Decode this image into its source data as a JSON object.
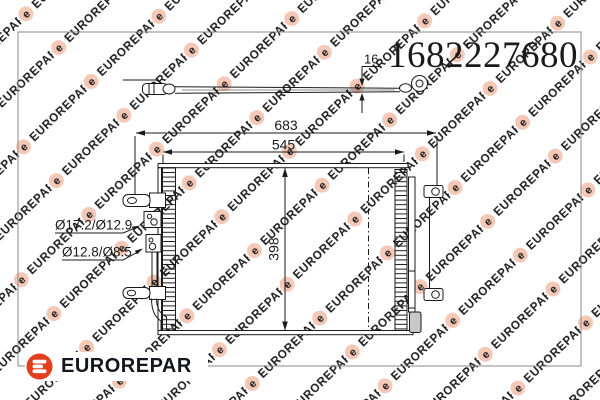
{
  "part_number": "1682227680",
  "watermark": {
    "text": "EUROREPAR",
    "letter": "e"
  },
  "logo": {
    "brand": "EUROREPAR"
  },
  "drawing": {
    "dimensions": {
      "overall_width": "683",
      "core_width": "545",
      "core_height": "398",
      "pipe_thickness": "16"
    },
    "fitting_labels": {
      "upper": "Ø17.2/Ø12.9",
      "lower": "Ø12.8/Ø8.5"
    }
  },
  "colors": {
    "line": "#1a1a1a",
    "frame_border": "#8a8a8a",
    "logo_red": "#e2401d",
    "logo_text": "#15151f",
    "watermark_text": "#dbd5d1",
    "watermark_badge": "#f4c8b6",
    "drier_cap_fill": "#c8c8c8"
  }
}
